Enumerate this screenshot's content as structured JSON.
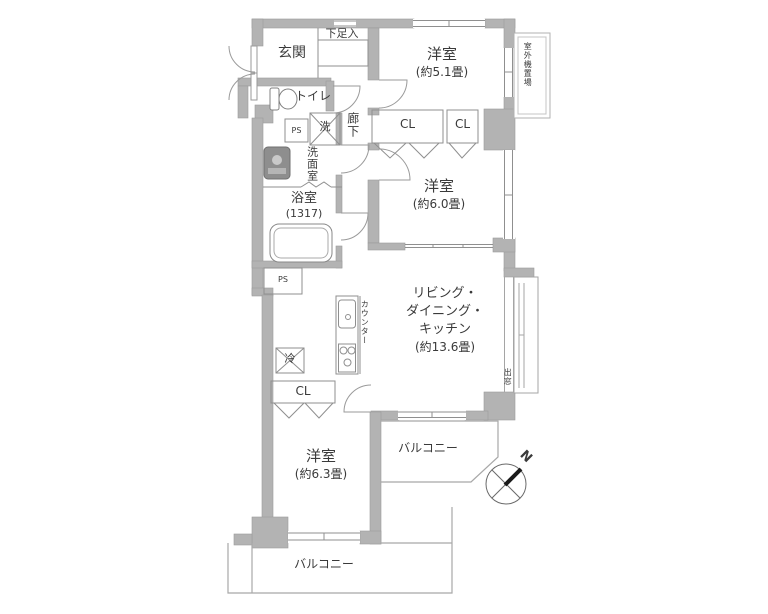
{
  "floorplan": {
    "rooms": {
      "genkan": {
        "label": "玄関"
      },
      "shoe_box": {
        "label": "下足入"
      },
      "bedroom1": {
        "name": "洋室",
        "size": "(約5.1畳)"
      },
      "outdoor_unit": {
        "label": "室外機置場"
      },
      "toilet": {
        "label": "トイレ"
      },
      "ps_upper": {
        "label": "PS"
      },
      "washer": {
        "label": "洗"
      },
      "corridor": {
        "label": "廊下"
      },
      "washroom": {
        "label": "洗面室"
      },
      "closet1": {
        "label": "CL"
      },
      "closet2": {
        "label": "CL"
      },
      "bedroom2": {
        "name": "洋室",
        "size": "(約6.0畳)"
      },
      "bath": {
        "name": "浴室",
        "size": "(1317)"
      },
      "ps_lower": {
        "label": "PS"
      },
      "ldk": {
        "line1": "リビング・",
        "line2": "ダイニング・",
        "line3": "キッチン",
        "size": "(約13.6畳)"
      },
      "counter": {
        "label": "カウンター"
      },
      "fridge": {
        "label": "冷"
      },
      "closet3": {
        "label": "CL"
      },
      "bedroom3": {
        "name": "洋室",
        "size": "(約6.3畳)"
      },
      "bay_window": {
        "label": "出窓"
      },
      "balcony_east": {
        "label": "バルコニー"
      },
      "balcony_south": {
        "label": "バルコニー"
      }
    },
    "compass": {
      "north": "N"
    }
  }
}
